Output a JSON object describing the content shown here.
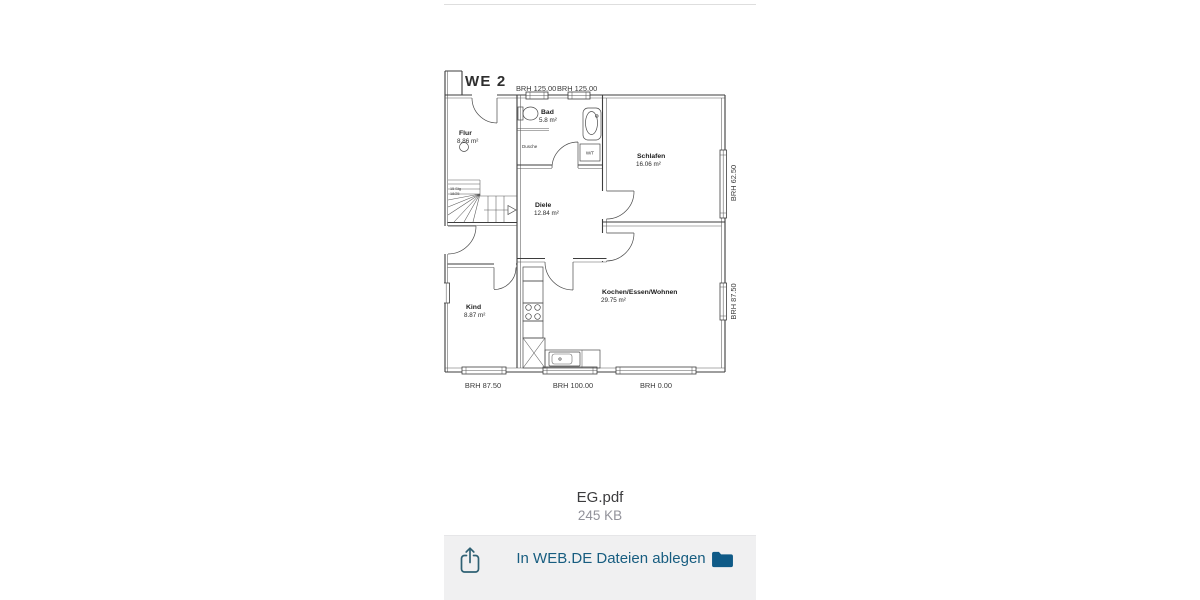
{
  "file": {
    "name": "EG.pdf",
    "size": "245 KB"
  },
  "toolbar": {
    "action_label": "In WEB.DE Dateien ablegen",
    "accent_color": "#175d80",
    "folder_color": "#0f5a87"
  },
  "floor_plan": {
    "unit_label": "WE 2",
    "rooms": [
      {
        "name": "Flur",
        "area": "8.86 m²"
      },
      {
        "name": "Bad",
        "area": "5.8 m²"
      },
      {
        "name": "Schlafen",
        "area": "16.06 m²"
      },
      {
        "name": "Diele",
        "area": "12.84 m²"
      },
      {
        "name": "Kind",
        "area": "8.87 m²"
      },
      {
        "name": "Kochen/Essen/Wohnen",
        "area": "29.75 m²"
      }
    ],
    "fixtures": {
      "shower": "Dusche",
      "washer_dryer": "W/T",
      "stairs_steps": "15 Stg",
      "stairs_ratio": "18/25"
    },
    "dimensions": {
      "top": [
        "BRH 125.00",
        "BRH 125.00"
      ],
      "right": [
        "BRH 62.50",
        "BRH 87.50"
      ],
      "bottom": [
        "BRH 87.50",
        "BRH 100.00",
        "BRH 0.00"
      ]
    }
  }
}
